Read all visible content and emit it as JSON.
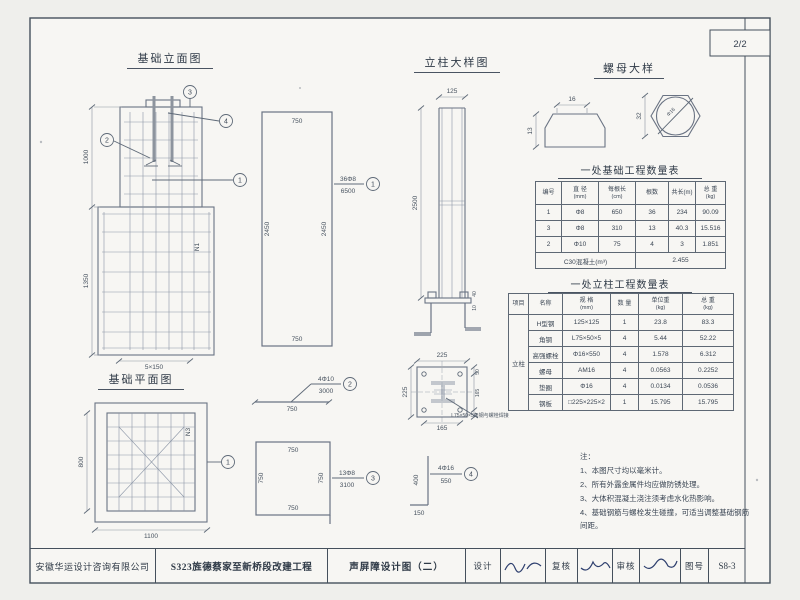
{
  "sheet": {
    "page_no": "2/2"
  },
  "titles": {
    "elevation": "基础立面图",
    "column": "立柱大样图",
    "nut": "螺母大样",
    "plan": "基础平面图",
    "foundation_table": "一处基础工程数量表",
    "column_table": "一处立柱工程数量表"
  },
  "elevation": {
    "dim_top": "1000",
    "dim_bottom": "1350",
    "dim_width": "5×150",
    "bar_mark": "N1",
    "callouts": {
      "c1": "1",
      "c2": "2",
      "c3": "3",
      "c4": "4"
    }
  },
  "plan": {
    "dim_left": "800",
    "dim_bottom": "1100",
    "bar_mark": "N3",
    "callout": "1"
  },
  "bars": {
    "b1": {
      "mark": "36Φ8",
      "length": "6500",
      "callout": "1",
      "dim_top": "750",
      "dim_left": "2450",
      "dim_right": "2450",
      "dim_bottom": "750"
    },
    "b2": {
      "mark": "4Φ10",
      "length": "3000",
      "callout": "2",
      "dim": "750"
    },
    "b3": {
      "mark": "13Φ8",
      "length": "3100",
      "callout": "3",
      "dim_top": "750",
      "dim_left": "750",
      "dim_right": "750",
      "dim_bottom": "750"
    },
    "b4": {
      "mark": "4Φ16",
      "length": "550",
      "callout": "4",
      "dim_v": "400",
      "dim_h": "150"
    }
  },
  "column_detail": {
    "dim_width": "125",
    "dim_height": "2500",
    "dim_bolt": "40",
    "dim_plate": "10"
  },
  "plate_detail": {
    "dim_top": "225",
    "dim_left": "225",
    "dim_bottom": "165",
    "dim_right": "165",
    "dim_offset": "50",
    "label": "L75×50×5角钢与螺栓焊接"
  },
  "nut_detail": {
    "dim_width": "16",
    "dim_height": "13",
    "dim_flats": "32",
    "dim_dia": "Φ16"
  },
  "foundation_table": {
    "headers": [
      {
        "t": "编号",
        "u": ""
      },
      {
        "t": "直 径",
        "u": "(mm)"
      },
      {
        "t": "每根长",
        "u": "(cm)"
      },
      {
        "t": "根数",
        "u": ""
      },
      {
        "t": "共长(m)",
        "u": ""
      },
      {
        "t": "总 重",
        "u": "(kg)"
      }
    ],
    "rows": [
      [
        "1",
        "Φ8",
        "650",
        "36",
        "234",
        "90.09"
      ],
      [
        "3",
        "Φ8",
        "310",
        "13",
        "40.3",
        "15.516"
      ],
      [
        "2",
        "Φ10",
        "75",
        "4",
        "3",
        "1.851"
      ]
    ],
    "footer": {
      "label": "C30混凝土(m³)",
      "value": "2.455"
    }
  },
  "column_table": {
    "headers": [
      {
        "t": "项目",
        "u": ""
      },
      {
        "t": "名称",
        "u": ""
      },
      {
        "t": "规 格",
        "u": "(mm)"
      },
      {
        "t": "数 量",
        "u": ""
      },
      {
        "t": "单位重",
        "u": "(kg)"
      },
      {
        "t": "总 重",
        "u": "(kg)"
      }
    ],
    "group": "立柱",
    "rows": [
      [
        "H型钢",
        "125×125",
        "1",
        "23.8",
        "83.3"
      ],
      [
        "角钢",
        "L75×50×5",
        "4",
        "5.44",
        "52.22"
      ],
      [
        "高强螺栓",
        "Φ16×550",
        "4",
        "1.578",
        "6.312"
      ],
      [
        "螺母",
        "AM16",
        "4",
        "0.0563",
        "0.2252"
      ],
      [
        "垫圈",
        "Φ16",
        "4",
        "0.0134",
        "0.0536"
      ],
      [
        "钢板",
        "□225×225×2",
        "1",
        "15.795",
        "15.795"
      ]
    ]
  },
  "notes": {
    "title": "注：",
    "items": [
      "1、本图尺寸均以毫米计。",
      "2、所有外露金属件均应做防锈处理。",
      "3、大体积混凝土浇注须考虑水化热影响。",
      "4、基础钢筋与螺栓发生碰撞，可适当调整基础钢筋间距。"
    ]
  },
  "titleblock": {
    "company": "安徽华运设计咨询有限公司",
    "project": "S323旌德蔡家至新桥段改建工程",
    "drawing_name": "声屏障设计图（二）",
    "design_label": "设计",
    "check_label": "复核",
    "review_label": "审核",
    "no_label": "图号",
    "drawing_no": "S8-3"
  }
}
